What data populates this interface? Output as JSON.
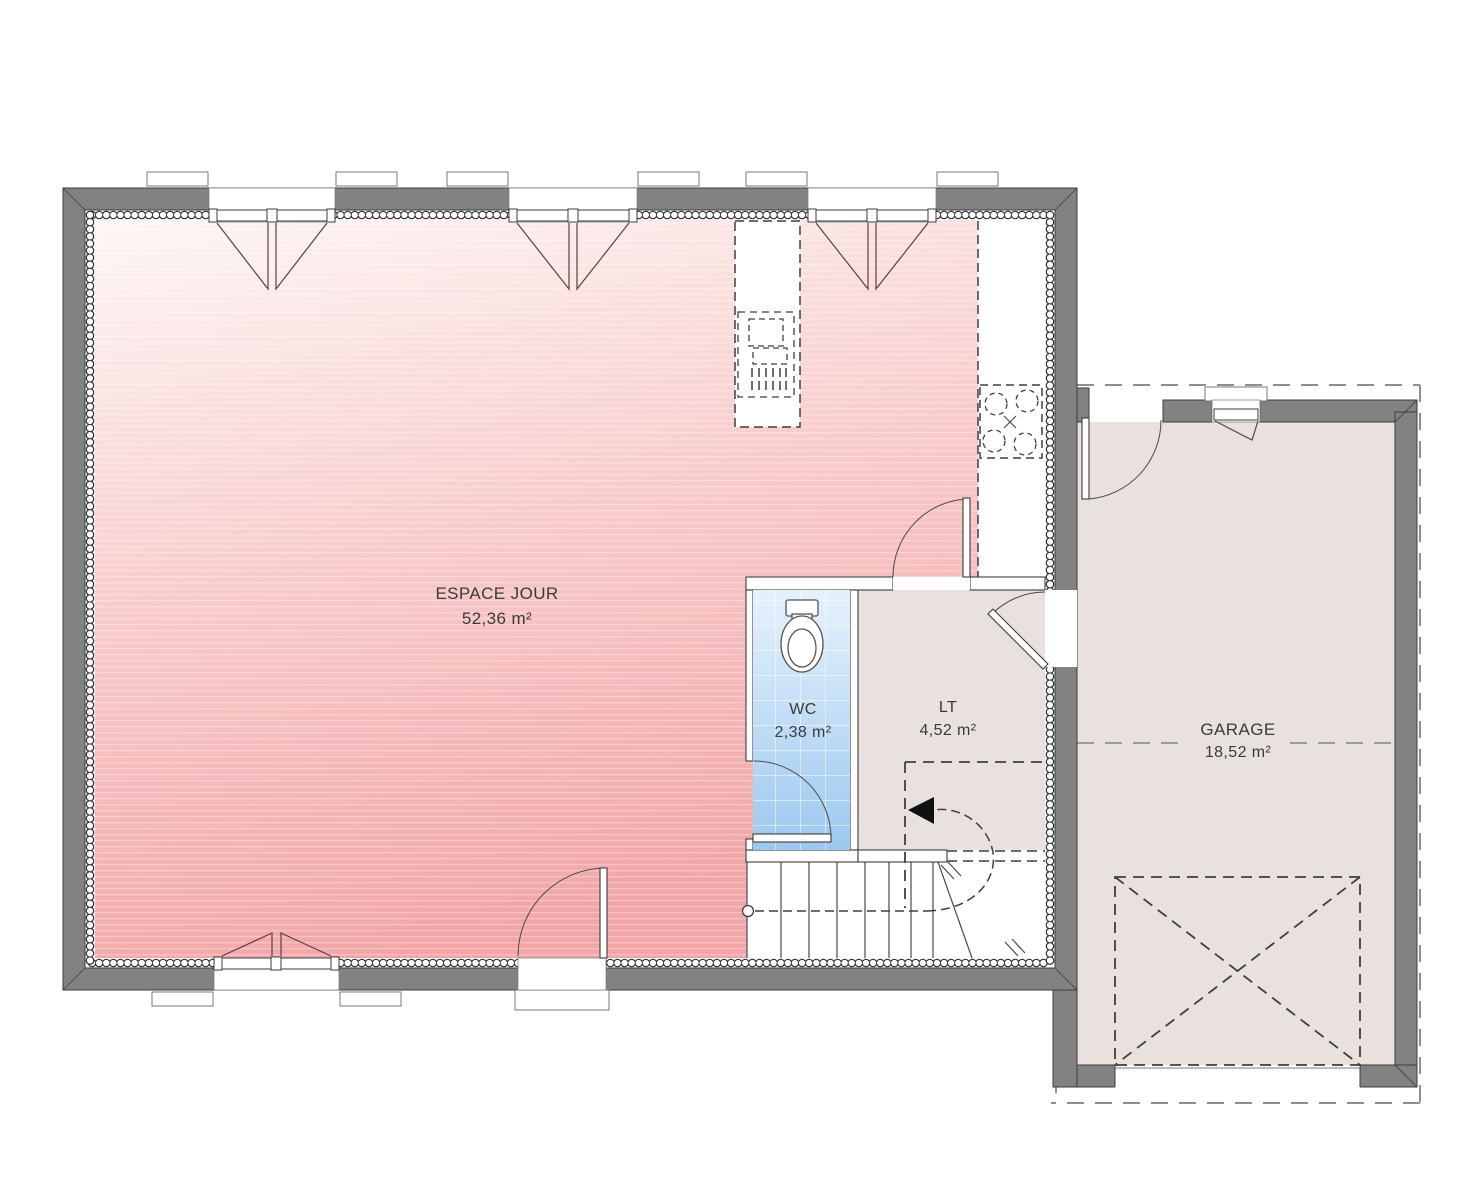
{
  "document": {
    "type": "floor-plan",
    "level": "rez-de-chaussee"
  },
  "rooms": [
    {
      "id": "espace_jour",
      "label": "ESPACE JOUR",
      "area": "52,36 m²"
    },
    {
      "id": "wc",
      "label": "WC",
      "area": "2,38 m²"
    },
    {
      "id": "lt",
      "label": "LT",
      "area": "4,52 m²"
    },
    {
      "id": "garage",
      "label": "GARAGE",
      "area": "18,52 m²"
    }
  ],
  "icons": [
    "toilet-icon",
    "sink-icon",
    "cooktop-icon",
    "stairs-icon",
    "door-swing-icon",
    "window-icon",
    "garage-door-icon",
    "direction-arrow-icon"
  ],
  "colors": {
    "wall_gray": "#828282",
    "line": "#3c3c3c",
    "living_light": "#fdf7f6",
    "living_mid": "#f8cbcb",
    "living_dark": "#f2a6a8",
    "annex_floor": "#e9e1de",
    "wc_light": "#e6f2fc",
    "wc_dark": "#9cc8ef",
    "stair_floor": "#ffffff",
    "casement": "#5a4044",
    "roof_dash": "#8f8f8f"
  }
}
